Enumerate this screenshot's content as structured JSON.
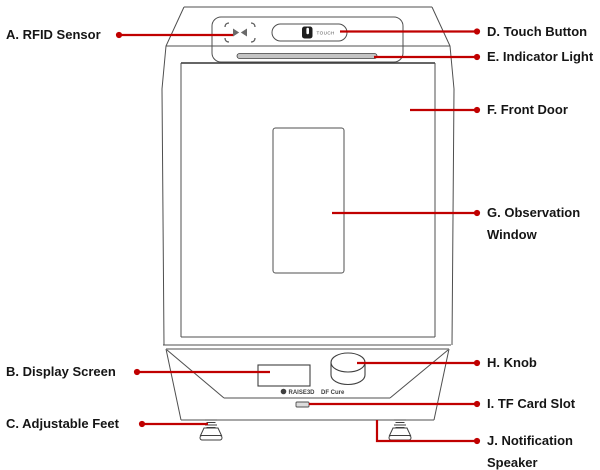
{
  "diagram": {
    "touch_button_text": "TOUCH",
    "brand": {
      "name": "RAISE3D",
      "model": "DF Cure"
    },
    "labels": [
      {
        "id": "A",
        "text": "A. RFID Sensor"
      },
      {
        "id": "B",
        "text": "B. Display Screen"
      },
      {
        "id": "C",
        "text": "C. Adjustable Feet"
      },
      {
        "id": "D",
        "text": "D. Touch Button"
      },
      {
        "id": "E",
        "text": "E. Indicator Light"
      },
      {
        "id": "F",
        "text": "F. Front Door"
      },
      {
        "id": "G",
        "text": "G. Observation Window"
      },
      {
        "id": "H",
        "text": "H. Knob"
      },
      {
        "id": "I",
        "text": "I. TF Card Slot"
      },
      {
        "id": "J",
        "text": "J. Notification Speaker"
      }
    ],
    "colors": {
      "leader_line": "#c00000",
      "device_outline": "#4f4f4f",
      "label_text": "#151515"
    }
  }
}
